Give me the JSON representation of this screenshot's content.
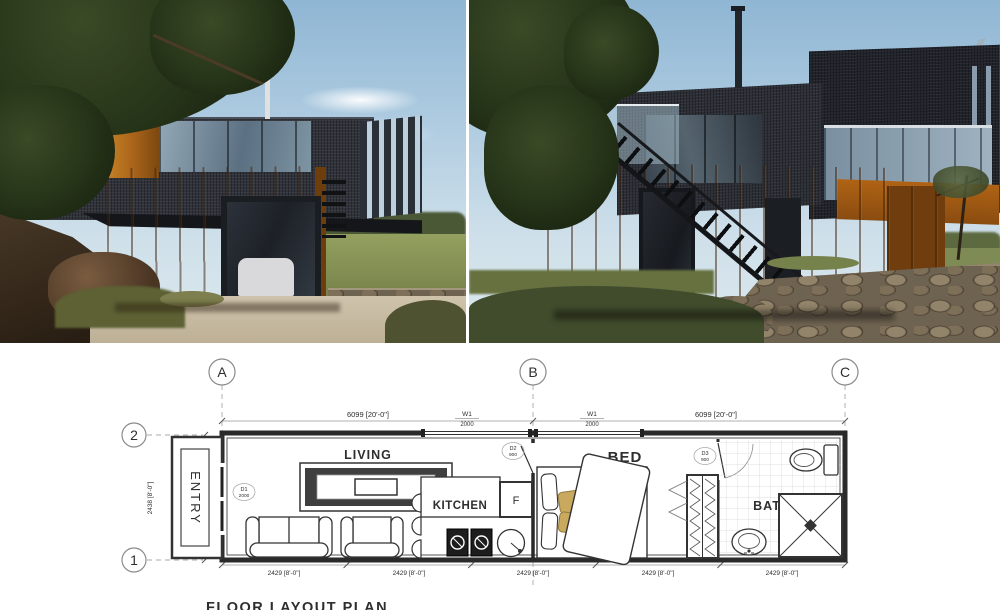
{
  "photos": {
    "left": {
      "description": "Corten shipping-container house, cantilevered charcoal upper container with glazing and louver fins above a rust-orange container on a rocky hillside"
    },
    "right": {
      "description": "Same container house from the far side: tall corten chimney, charcoal clad upper container with angled louver fins, external black steel stair, dry stone wall"
    }
  },
  "plan": {
    "grid_columns": [
      "A",
      "B",
      "C"
    ],
    "grid_rows": [
      "2",
      "1"
    ],
    "dimensions": {
      "top_left_span": "6099 [20'-0\"]",
      "top_right_span": "6099 [20'-0\"]",
      "side_span": "2438 [8'-0\"]",
      "bottom_spans": [
        "2429 [8'-0\"]",
        "2429 [8'-0\"]",
        "2429 [8'-0\"]",
        "2429 [8'-0\"]",
        "2429 [8'-0\"]"
      ]
    },
    "windows": {
      "w1_left": {
        "tag": "W1",
        "size": "2000"
      },
      "w1_right": {
        "tag": "W1",
        "size": "2000"
      }
    },
    "doors": {
      "d1": {
        "tag": "D1",
        "size": "2000"
      },
      "d2": {
        "tag": "D2",
        "size": "900"
      },
      "d3": {
        "tag": "D3",
        "size": "900"
      }
    },
    "rooms": {
      "entry": "ENTRY",
      "living_line1": "LIVING",
      "living_line2": "ROOM",
      "kitchen": "KITCHEN",
      "fridge": "F",
      "bed": "BED",
      "bath": "BATH"
    },
    "title": "FLOOR LAYOUT PLAN"
  },
  "colors": {
    "corten": "#b26a1c",
    "charcoal": "#2b2e35",
    "sky": "#a9c9de",
    "glass": "#8aa0b0",
    "plan_line": "#2a2a2a",
    "dim_line": "#999999",
    "pillow_accent": "#c9a95e",
    "tile_line": "#d5d5d5"
  }
}
